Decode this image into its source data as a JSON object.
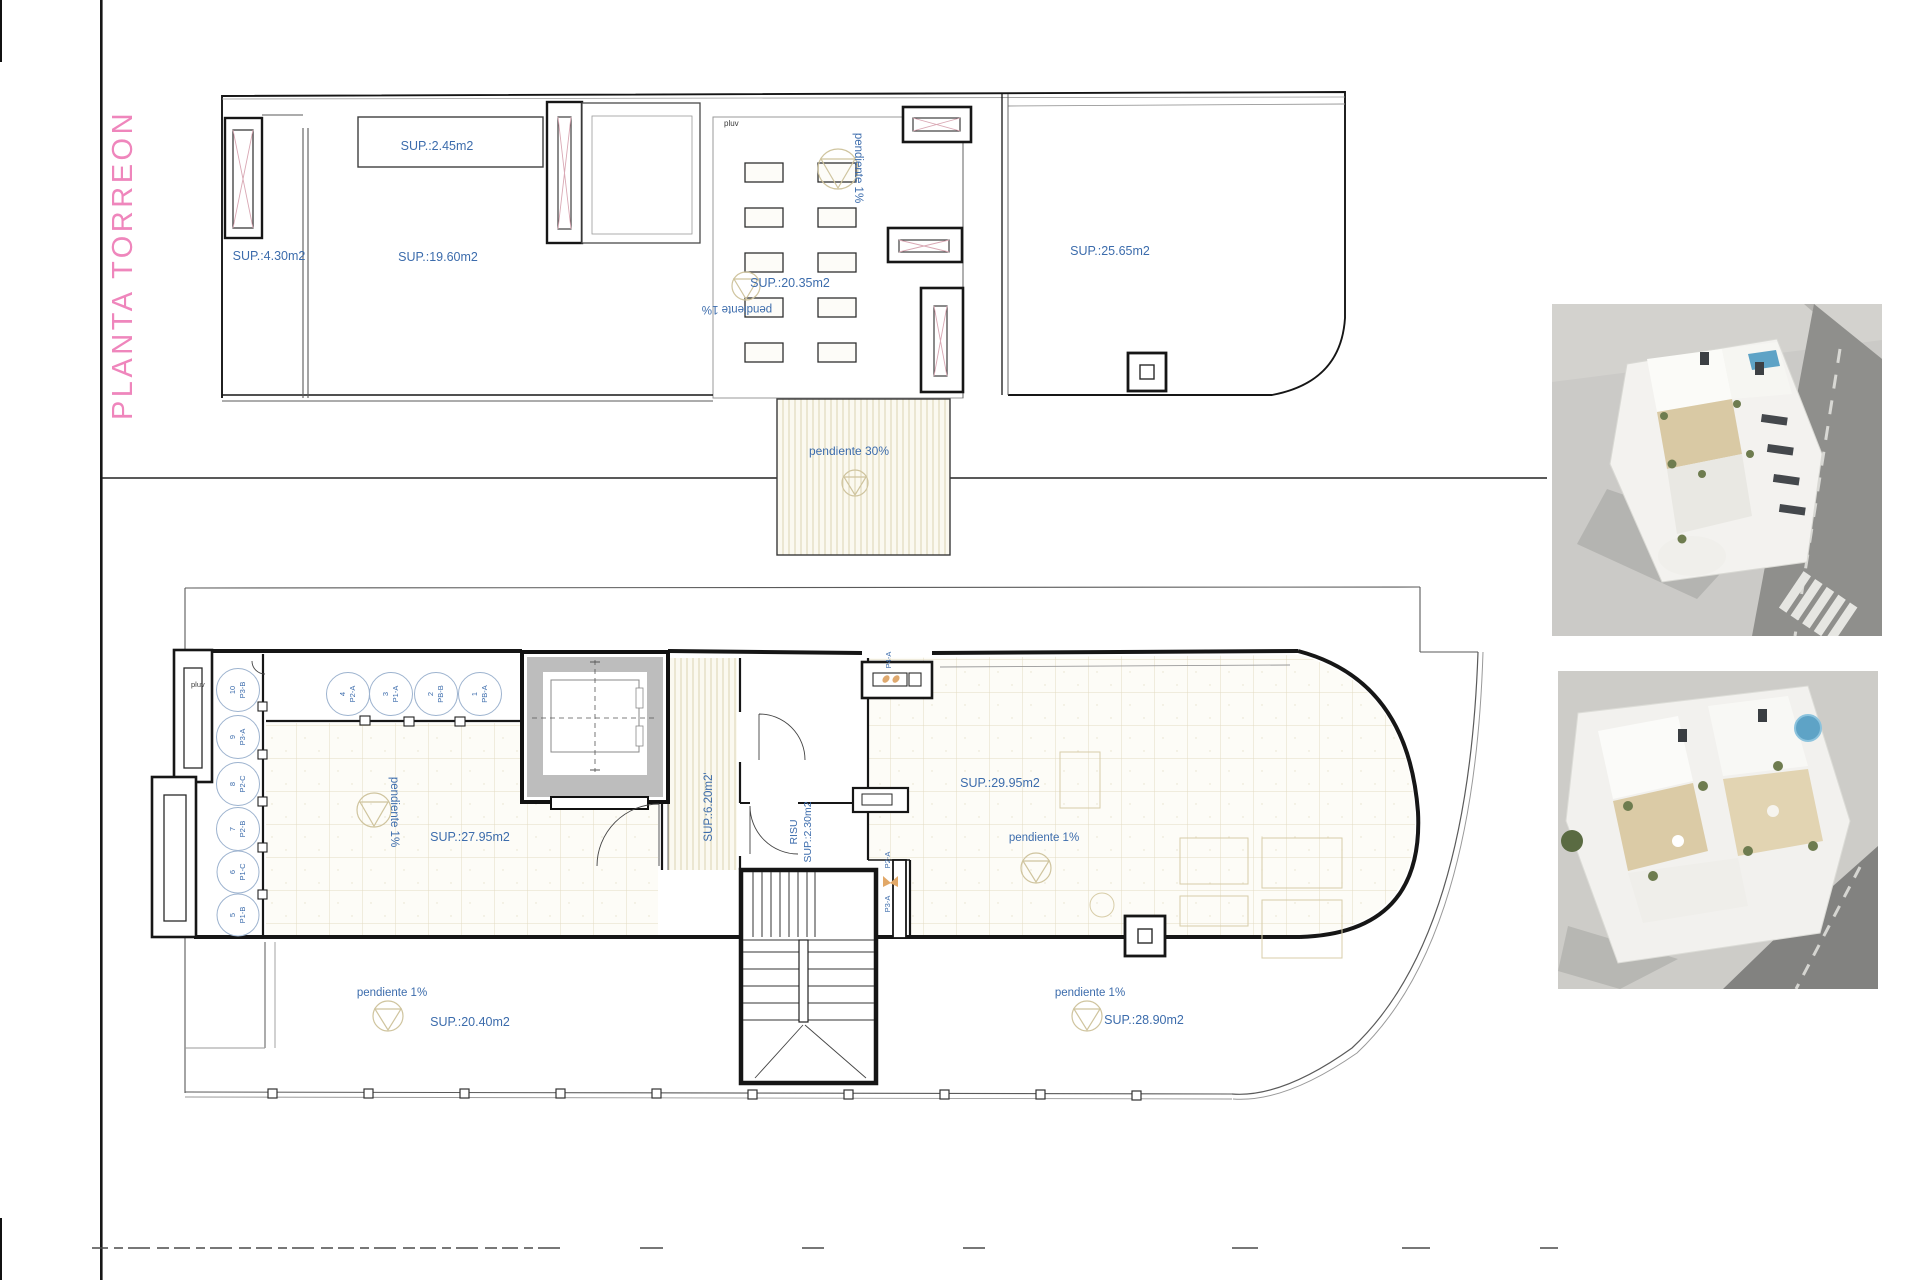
{
  "page": {
    "title": "PLANTA TORREON",
    "title_color": "#ef86bc",
    "label_color": "#3c6cac"
  },
  "top_plan": {
    "room_labels": {
      "box": "SUP.:2.45m2",
      "left": "SUP.:4.30m2",
      "main": "SUP.:19.60m2",
      "terrace": "SUP.:20.35m2",
      "right": "SUP.:25.65m2"
    },
    "notes": {
      "pluv": "pluv",
      "pendiente_v": "pendiente 1%",
      "pendiente_flip": "pendiente 1%",
      "ramp": "pendiente 30%"
    }
  },
  "bottom_plan": {
    "room_labels": {
      "left": "SUP.:27.95m2",
      "corridor": "SUP.:6.20m2'",
      "risu_title": "RISU",
      "risu_area": "SUP.:2.30m2",
      "right": "SUP.:29.95m2",
      "terrace_left": "SUP.:20.40m2",
      "terrace_right": "SUP.:28.90m2"
    },
    "notes": {
      "pluv": "pluv",
      "pend_left_v": "pendiente 1%",
      "pend_right": "pendiente 1%",
      "pend_terr_left": "pendiente 1%",
      "pend_terr_right": "pendiente 1%"
    },
    "ducts": {
      "top": "P4-A",
      "mid_upper": "P2-A",
      "mid_lower": "P3-A"
    },
    "risers_left": [
      {
        "num": "10",
        "code": "P3-B"
      },
      {
        "num": "9",
        "code": "P3-A"
      },
      {
        "num": "8",
        "code": "P2-C"
      },
      {
        "num": "7",
        "code": "P2-B"
      },
      {
        "num": "6",
        "code": "P1-C"
      },
      {
        "num": "5",
        "code": "P1-B"
      }
    ],
    "risers_top": [
      {
        "num": "4",
        "code": "P2-A"
      },
      {
        "num": "3",
        "code": "P1-A"
      },
      {
        "num": "2",
        "code": "PB-B"
      },
      {
        "num": "1",
        "code": "PB-A"
      }
    ]
  }
}
